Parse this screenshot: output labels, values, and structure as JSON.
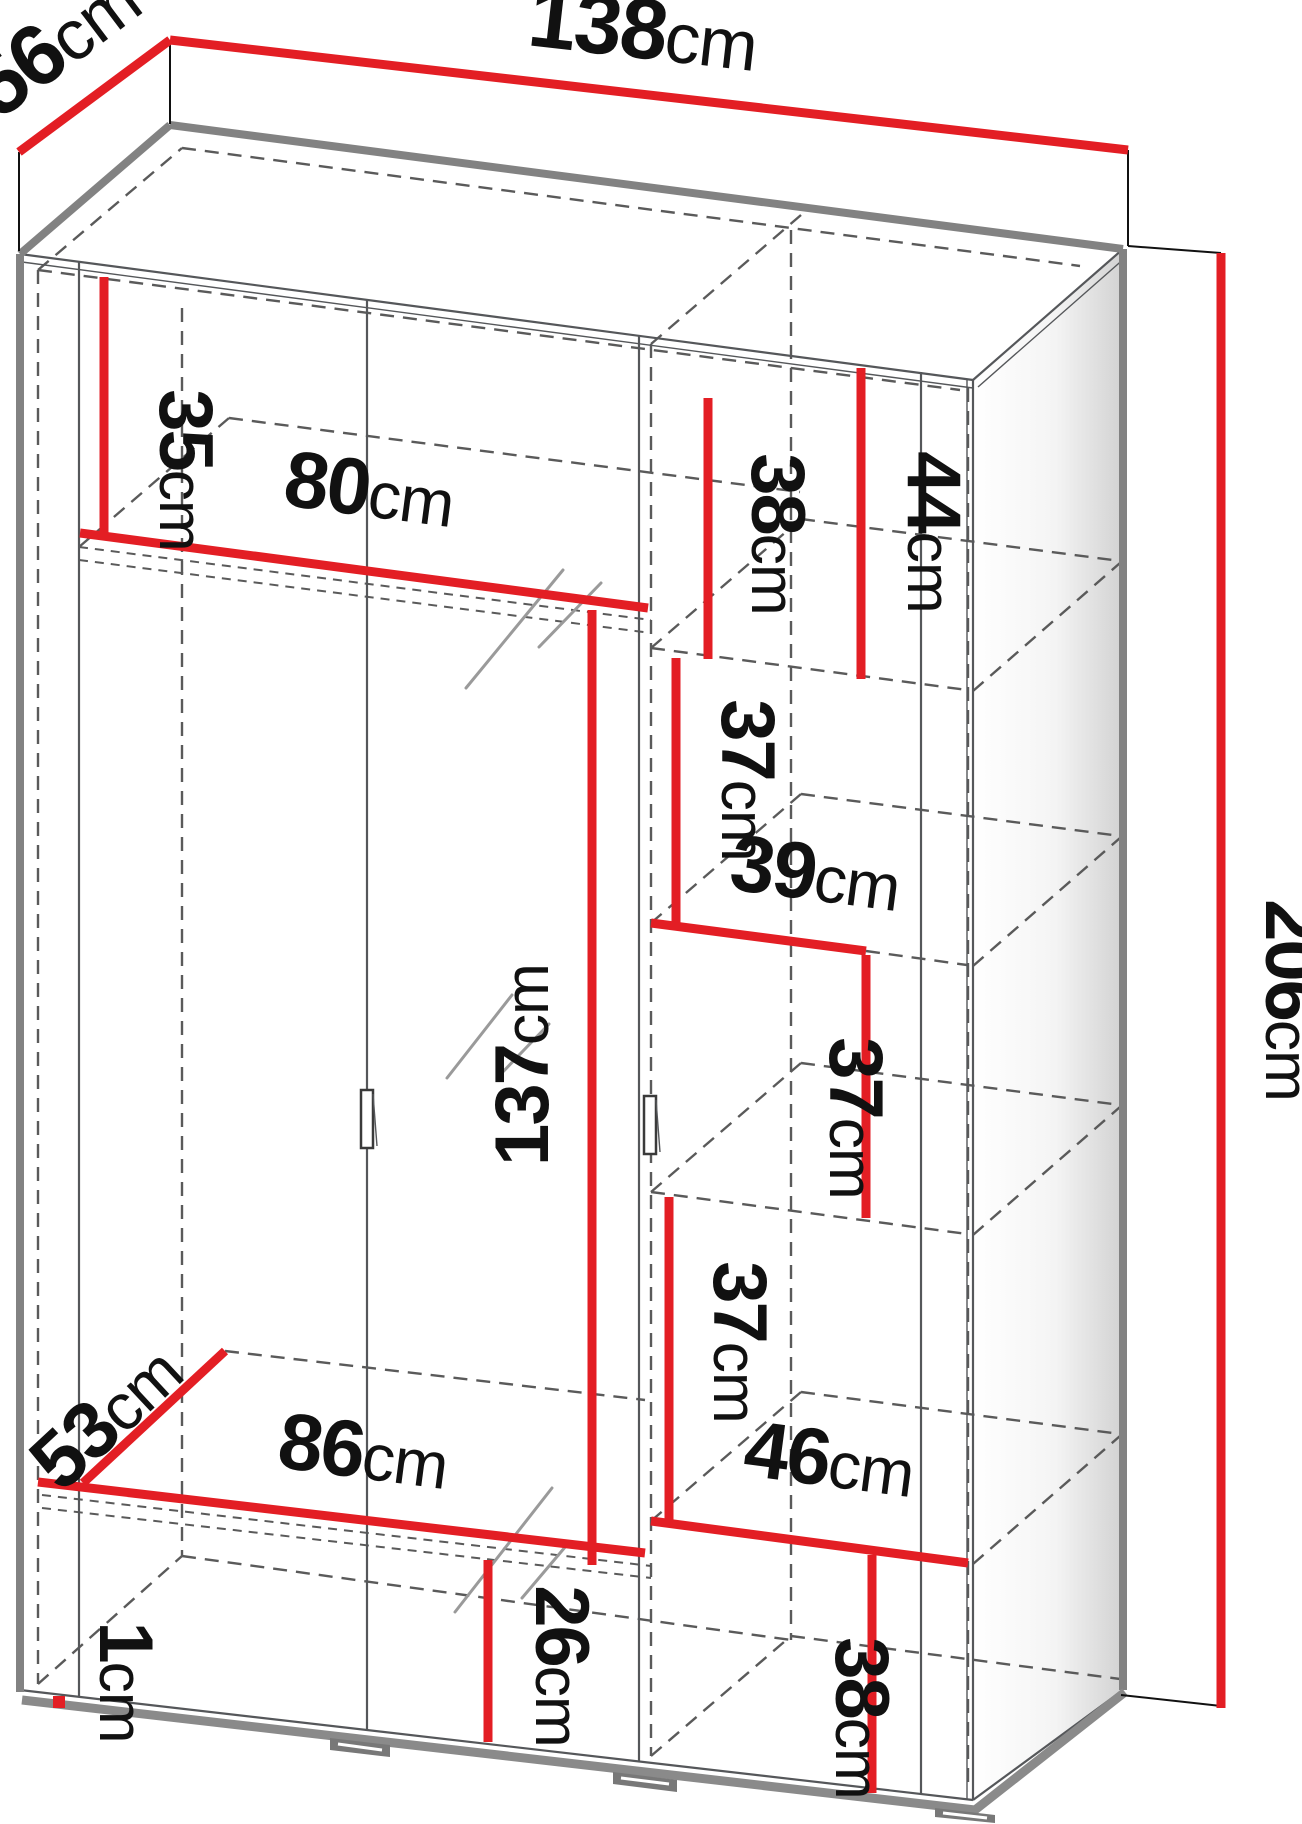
{
  "diagram": {
    "colors": {
      "dimension_line": "#e31e24",
      "outline_gray": "#828282",
      "detail_gray": "#55575a",
      "label_text": "#111111"
    },
    "dimensions": {
      "width_top": {
        "value": "138",
        "unit": "cm"
      },
      "depth_top": {
        "value": "56",
        "unit": "cm"
      },
      "height_right": {
        "value": "206",
        "unit": "cm"
      },
      "top_shelf_drop": {
        "value": "35",
        "unit": "cm"
      },
      "left_width": {
        "value": "80",
        "unit": "cm"
      },
      "door_height": {
        "value": "137",
        "unit": "cm"
      },
      "right_front_top": {
        "value": "38",
        "unit": "cm"
      },
      "right_back_top": {
        "value": "44",
        "unit": "cm"
      },
      "right_shelf_a": {
        "value": "37",
        "unit": "cm"
      },
      "right_width_mid": {
        "value": "39",
        "unit": "cm"
      },
      "right_shelf_b": {
        "value": "37",
        "unit": "cm"
      },
      "right_shelf_c": {
        "value": "37",
        "unit": "cm"
      },
      "right_width_low": {
        "value": "46",
        "unit": "cm"
      },
      "right_shelf_low": {
        "value": "38",
        "unit": "cm"
      },
      "bottom_space": {
        "value": "26",
        "unit": "cm"
      },
      "floor_width": {
        "value": "86",
        "unit": "cm"
      },
      "floor_depth": {
        "value": "53",
        "unit": "cm"
      },
      "plinth_height": {
        "value": "1",
        "unit": "cm"
      }
    }
  }
}
